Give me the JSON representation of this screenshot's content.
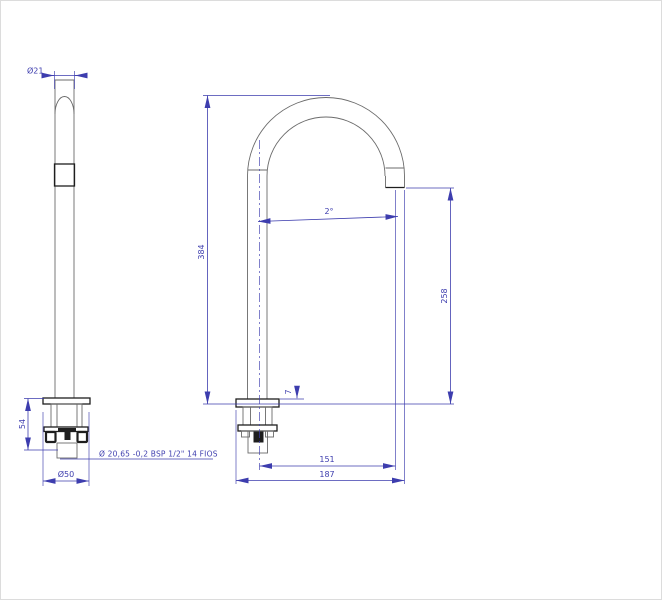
{
  "colors": {
    "dim": "#3d3dae",
    "geo": "#6b6b6b",
    "dark": "#1e1e1e",
    "bg": "#ffffff"
  },
  "side_view": {
    "tube_diameter": "Ø21",
    "under_counter_height": "54",
    "base_diameter": "Ø50",
    "thread_spec": "Ø 20,65 -0,2 BSP 1/2\" 14 FIOS"
  },
  "front_view": {
    "total_height": "384",
    "spout_outlet_height": "258",
    "spout_angle": "2°",
    "base_plate_thickness": "7",
    "center_to_outlet": "151",
    "max_projection": "187"
  }
}
